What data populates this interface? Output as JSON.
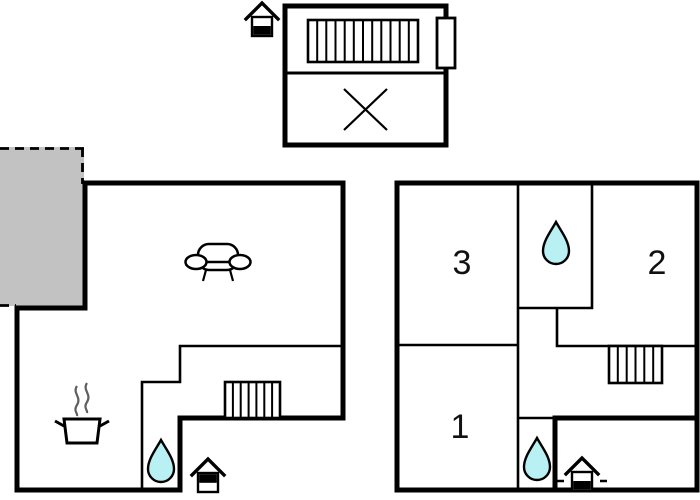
{
  "canvas": {
    "width": 700,
    "height": 500,
    "background": "#ffffff"
  },
  "colors": {
    "wall": "#000000",
    "terrace_fill": "#c2c2c2",
    "water_drop_fill": "#b9f0f3",
    "steam": "#5f5f5f",
    "label_text": "#111111"
  },
  "floor_plans": {
    "upper": {
      "id": "upper-floor-plan",
      "icons": [
        "entrance-house-icon",
        "staircase-icon",
        "window-icon",
        "closed-area-cross-icon"
      ]
    },
    "ground": {
      "id": "ground-floor-plan",
      "icons": [
        "terrace-area",
        "sofa-icon",
        "cooking-pot-icon",
        "staircase-icon",
        "water-drop-icon",
        "entrance-house-icon"
      ]
    },
    "first": {
      "id": "first-floor-plan",
      "rooms": [
        {
          "label": "3"
        },
        {
          "label": "2"
        },
        {
          "label": "1"
        }
      ],
      "icons": [
        "water-drop-icon",
        "water-drop-icon",
        "staircase-icon",
        "entrance-house-icon"
      ]
    }
  }
}
